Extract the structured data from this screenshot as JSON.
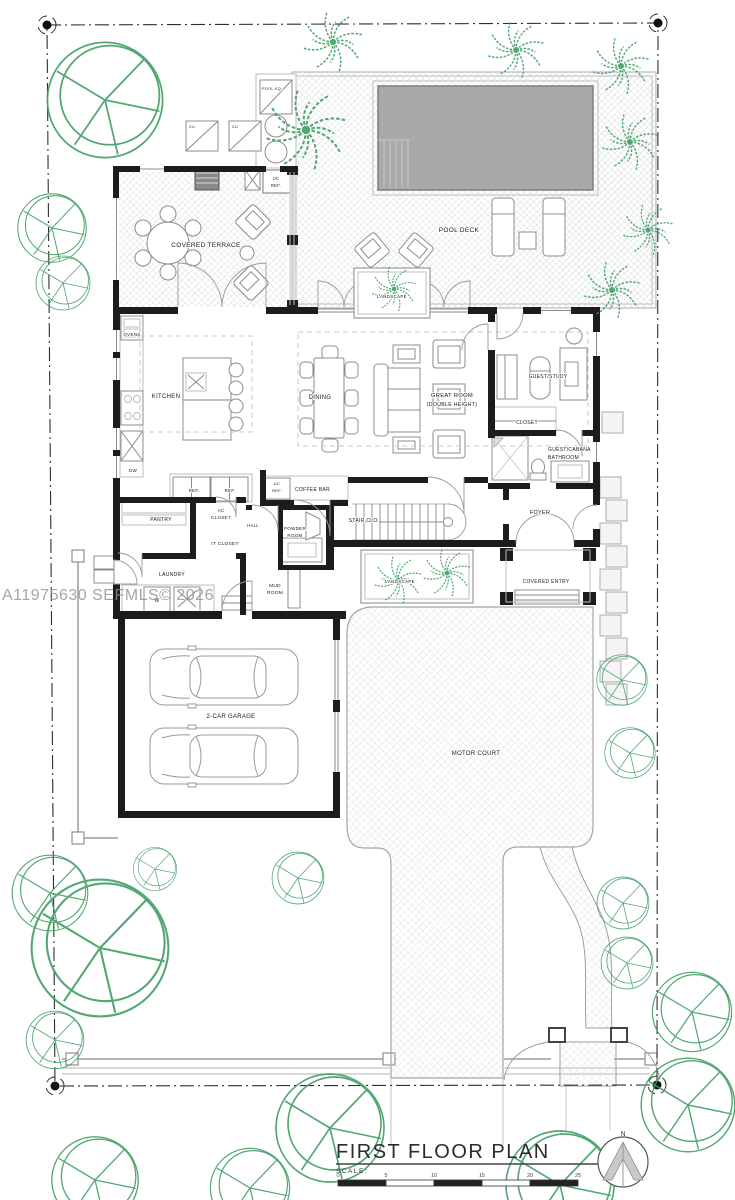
{
  "watermark": "A11975630  SEFMLS© 2026",
  "colors": {
    "tree_green": "#3f9e62",
    "pool_gray": "#a9a9a9",
    "wall_black": "#1c1c1c"
  },
  "title_block": {
    "title": "FIRST FLOOR PLAN",
    "scale_label": "SCALE:",
    "north_label": "N",
    "scale_ticks": [
      "0",
      "5",
      "10",
      "15",
      "20",
      "25"
    ]
  },
  "labels": {
    "pool_eq": "POOL EQ.",
    "cu_1": "CU",
    "cu_2": "CU",
    "uc_ref_terrace_1": "UC",
    "uc_ref_terrace_2": "REF.",
    "covered_terrace": "COVERED TERRACE",
    "pool_deck": "POOL DECK",
    "landscape_upper": "LANDSCAPE",
    "landscape_lower": "LANDSCAPE",
    "ovens": "OVENS",
    "kitchen": "KITCHEN",
    "dw": "DW",
    "ref_1": "REF.",
    "ref_2": "REF.",
    "uc_ref_bar_1": "UC",
    "uc_ref_bar_2": "REF.",
    "coffee_bar": "COFFEE BAR",
    "dining": "DINING",
    "great_room_1": "GREAT ROOM",
    "great_room_2": "(DOUBLE HEIGHT)",
    "guest_study": "GUEST/STUDY",
    "closet": "CLOSET",
    "guest_cabana_1": "GUEST/CABANA",
    "guest_cabana_2": "BATHROOM",
    "foyer": "FOYER",
    "stair_clo": "STAIR CLO.",
    "pantry": "PANTRY",
    "ac_closet_1": "AC",
    "ac_closet_2": "CLOSET",
    "hall": "HALL",
    "it_closet": "IT CLOSET",
    "powder_1": "POWDER",
    "powder_2": "ROOM",
    "laundry": "LAUNDRY",
    "washer": "W",
    "mud_1": "MUD",
    "mud_2": "ROOM",
    "covered_entry": "COVERED ENTRY",
    "garage": "2-CAR GARAGE",
    "motor_court": "MOTOR COURT"
  }
}
